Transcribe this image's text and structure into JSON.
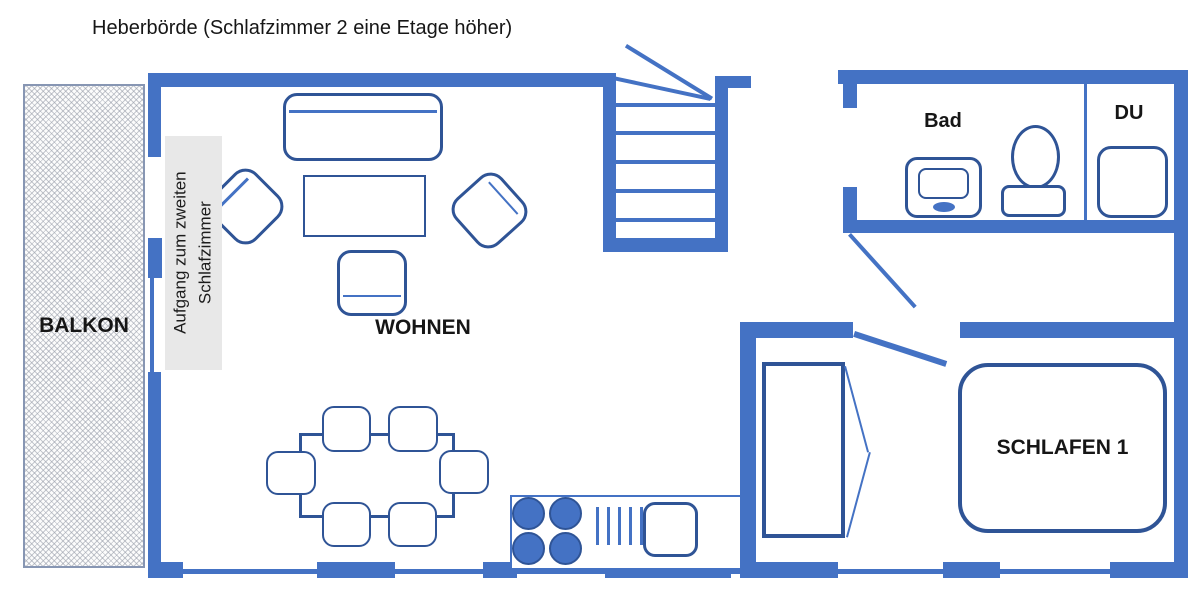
{
  "title": "Heberbörde (Schlafzimmer 2 eine Etage höher)",
  "rooms": {
    "balkon": {
      "label": "BALKON"
    },
    "wohnen": {
      "label": "WOHNEN"
    },
    "bad": {
      "label": "Bad"
    },
    "du": {
      "label": "DU"
    },
    "schlafen1": {
      "label": "SCHLAFEN 1"
    },
    "aufgang": {
      "line1": "Aufgang zum zweiten",
      "line2": "Schlafzimmer"
    }
  },
  "colors": {
    "wall-blue": "#4472C4",
    "furniture-navy": "#2F5496",
    "panel-gray": "#e8e8e8",
    "text-black": "#161616"
  }
}
